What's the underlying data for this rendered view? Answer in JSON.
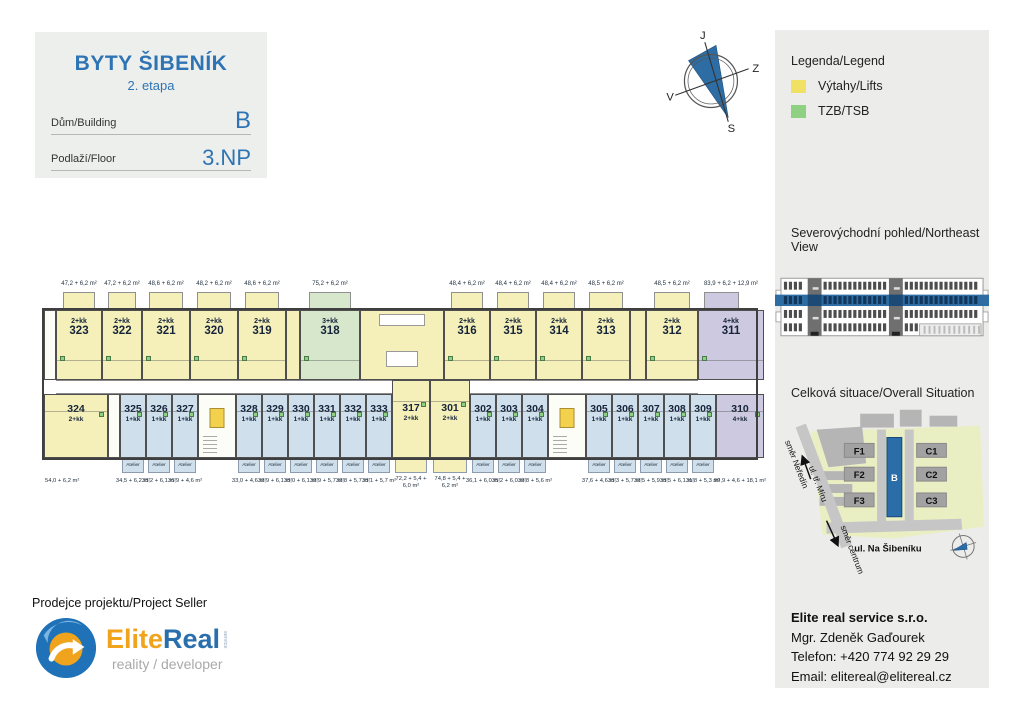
{
  "header": {
    "title": "BYTY ŠIBENÍK",
    "subtitle": "2. etapa",
    "building_label": "Dům/Building",
    "building_value": "B",
    "floor_label": "Podlaží/Floor",
    "floor_value": "3.NP"
  },
  "compass": {
    "top": "J",
    "right": "Z",
    "bottom": "S",
    "left": "V"
  },
  "sidebar": {
    "legend": {
      "title": "Legenda/Legend",
      "items": [
        {
          "label": "Výtahy/Lifts",
          "color": "#f0e064"
        },
        {
          "label": "TZB/TSB",
          "color": "#8fd182"
        }
      ]
    },
    "elevation": {
      "title": "Severovýchodní pohled/Northeast View",
      "highlight_color": "#2e6da4"
    },
    "situation": {
      "title": "Celková situace/Overall Situation",
      "blocks": [
        "F1",
        "F2",
        "F3",
        "C1",
        "C2",
        "C3"
      ],
      "highlight_block": "B",
      "street": "ul. Na Šibeníku",
      "road": "ul. tř. Míru",
      "direction_up": "směr Neředín",
      "direction_down": "směr centrum"
    },
    "contact": {
      "company": "Elite real service s.r.o.",
      "person": "Mgr. Zdeněk Gaďourek",
      "phone": "Telefon: +420 774 92 29 29",
      "email": "Email: elitereal@elitereal.cz"
    }
  },
  "footer": {
    "seller_title": "Prodejce projektu/Project Seller",
    "logo_part1": "Elite",
    "logo_part2": "Real",
    "logo_service": "service",
    "logo_tagline": "reality / developer"
  },
  "floorplan": {
    "atelier_label": "Atelier",
    "colors": {
      "yellow": "#f5f0b9",
      "green": "#d6e7cc",
      "blue": "#cfe0ec",
      "purple": "#cdc9e0",
      "white": "#fdfdf8",
      "elevator": "#f4d14d",
      "tzb": "#8fd182",
      "wall": "#3f3f3f"
    },
    "top_units": [
      {
        "kind": "spacer",
        "color": "white",
        "w": 12
      },
      {
        "num": "323",
        "type": "2+kk",
        "area": "47,2 + 6,2 m²",
        "color": "yellow",
        "w": 46
      },
      {
        "num": "322",
        "type": "2+kk",
        "area": "47,2 + 6,2 m²",
        "color": "yellow",
        "w": 40
      },
      {
        "num": "321",
        "type": "2+kk",
        "area": "48,6 + 6,2 m²",
        "color": "yellow",
        "w": 48
      },
      {
        "num": "320",
        "type": "2+kk",
        "area": "48,2 + 6,2 m²",
        "color": "yellow",
        "w": 48
      },
      {
        "num": "319",
        "type": "2+kk",
        "area": "48,6 + 6,2 m²",
        "color": "yellow",
        "w": 48
      },
      {
        "kind": "spacer",
        "color": "yellow",
        "w": 14
      },
      {
        "num": "318",
        "type": "3+kk",
        "area": "75,2 + 6,2 m²",
        "color": "green",
        "w": 60
      },
      {
        "kind": "core",
        "color": "yellow",
        "w": 84
      },
      {
        "num": "316",
        "type": "2+kk",
        "area": "48,4 + 6,2 m²",
        "color": "yellow",
        "w": 46
      },
      {
        "num": "315",
        "type": "2+kk",
        "area": "48,4 + 6,2 m²",
        "color": "yellow",
        "w": 46
      },
      {
        "num": "314",
        "type": "2+kk",
        "area": "48,4 + 6,2 m²",
        "color": "yellow",
        "w": 46
      },
      {
        "num": "313",
        "type": "2+kk",
        "area": "48,5 + 6,2 m²",
        "color": "yellow",
        "w": 48
      },
      {
        "kind": "spacer",
        "color": "yellow",
        "w": 16
      },
      {
        "num": "312",
        "type": "2+kk",
        "area": "48,5 + 6,2 m²",
        "color": "yellow",
        "w": 52
      },
      {
        "num": "311",
        "type": "4+kk",
        "area": "83,9 + 6,2 + 12,9 m²",
        "color": "purple",
        "w": 66,
        "fill": true,
        "typeFirst": true
      }
    ],
    "bottom_units": [
      {
        "num": "324",
        "type": "2+kk",
        "area": "54,0 + 6,2 m²",
        "color": "yellow",
        "w": 64,
        "numFirst": true,
        "areaLeft": true
      },
      {
        "kind": "gap",
        "color": "white",
        "w": 12
      },
      {
        "num": "325",
        "type": "1+kk",
        "area": "34,5 + 6,2 m²",
        "color": "blue",
        "w": 26,
        "atelier": true,
        "numFirst": true
      },
      {
        "num": "326",
        "type": "1+kk",
        "area": "33,2 + 6,1 m²",
        "color": "blue",
        "w": 26,
        "atelier": true,
        "numFirst": true
      },
      {
        "num": "327",
        "type": "1+kk",
        "area": "36,9 + 4,6 m²",
        "color": "blue",
        "w": 26,
        "atelier": true,
        "numFirst": true
      },
      {
        "kind": "core",
        "color": "white",
        "w": 38
      },
      {
        "num": "328",
        "type": "1+kk",
        "area": "33,0 + 4,6 m²",
        "color": "blue",
        "w": 26,
        "atelier": true,
        "numFirst": true
      },
      {
        "num": "329",
        "type": "1+kk",
        "area": "32,9 + 6,1 m²",
        "color": "blue",
        "w": 26,
        "atelier": true,
        "numFirst": true
      },
      {
        "num": "330",
        "type": "1+kk",
        "area": "33,0 + 6,1 m²",
        "color": "blue",
        "w": 26,
        "atelier": true,
        "numFirst": true
      },
      {
        "num": "331",
        "type": "1+kk",
        "area": "32,9 + 5,7 m²",
        "color": "blue",
        "w": 26,
        "atelier": true,
        "numFirst": true
      },
      {
        "num": "332",
        "type": "1+kk",
        "area": "32,8 + 5,7 m²",
        "color": "blue",
        "w": 26,
        "atelier": true,
        "numFirst": true
      },
      {
        "num": "333",
        "type": "1+kk",
        "area": "33,1 + 5,7 m²",
        "color": "blue",
        "w": 26,
        "atelier": true,
        "numFirst": true
      },
      {
        "num": "317",
        "type": "2+kk",
        "area": "72,2 + 5,4 +|6,0 m²",
        "color": "yellow",
        "w": 38,
        "tall": true,
        "numFirst": true
      },
      {
        "num": "301",
        "type": "2+kk",
        "area": "74,8 + 5,4 +|6,2 m²",
        "color": "yellow",
        "w": 40,
        "tall": true,
        "numFirst": true
      },
      {
        "num": "302",
        "type": "1+kk",
        "area": "36,1 + 6,0 m²",
        "color": "blue",
        "w": 26,
        "atelier": true,
        "numFirst": true
      },
      {
        "num": "303",
        "type": "1+kk",
        "area": "35,2 + 6,0 m²",
        "color": "blue",
        "w": 26,
        "atelier": true,
        "numFirst": true
      },
      {
        "num": "304",
        "type": "1+kk",
        "area": "32,8 + 5,6 m²",
        "color": "blue",
        "w": 26,
        "atelier": true,
        "numFirst": true
      },
      {
        "kind": "core",
        "color": "white",
        "w": 38
      },
      {
        "num": "305",
        "type": "1+kk",
        "area": "37,6 + 4,6 m²",
        "color": "blue",
        "w": 26,
        "atelier": true,
        "numFirst": true
      },
      {
        "num": "306",
        "type": "1+kk",
        "area": "33,3 + 5,7 m²",
        "color": "blue",
        "w": 26,
        "atelier": true,
        "numFirst": true
      },
      {
        "num": "307",
        "type": "1+kk",
        "area": "32,5 + 5,9 m²",
        "color": "blue",
        "w": 26,
        "atelier": true,
        "numFirst": true
      },
      {
        "num": "308",
        "type": "1+kk",
        "area": "33,5 + 6,1 m²",
        "color": "blue",
        "w": 26,
        "atelier": true,
        "numFirst": true
      },
      {
        "num": "309",
        "type": "1+kk",
        "area": "31,8 + 5,3 m²",
        "color": "blue",
        "w": 26,
        "atelier": true,
        "numFirst": true
      },
      {
        "num": "310",
        "type": "4+kk",
        "area": "99,9 + 4,6 + 18,1 m²",
        "color": "purple",
        "w": 48,
        "numFirst": true,
        "fill": true
      }
    ]
  }
}
